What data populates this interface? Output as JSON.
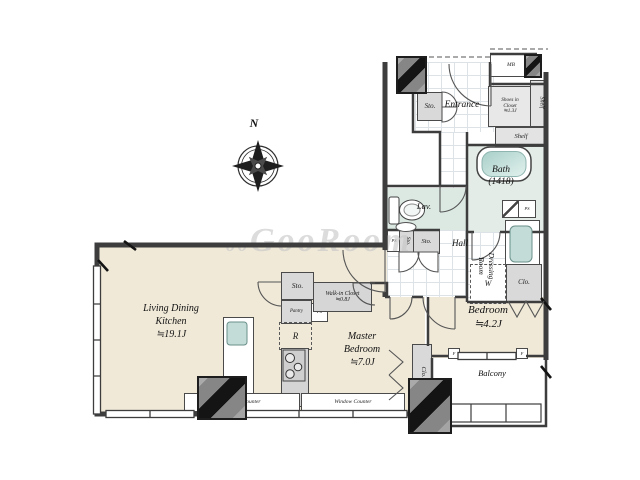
{
  "colors": {
    "floor_beige": "#f0e9d8",
    "wet_area_teal": "#dce9e3",
    "fixture_teal": "#b9d6d1",
    "wall_dark": "#3d3d3d",
    "closet_gray": "#d9d9d9",
    "watermark_gray": "#c7c7c7"
  },
  "watermark": {
    "prefix": "oo",
    "text": "GooRoom"
  },
  "compass": {
    "north": "N"
  },
  "labels": {
    "ldk": "Living Dining\nKitchen\n≒19.1J",
    "master_bedroom": "Master\nBedroom\n≒7.0J",
    "bedroom": "Bedroom\n≒4.2J",
    "balcony": "Balcony",
    "bath": "Bath\n(1418)",
    "lav": "Lav.",
    "hall": "Hall",
    "entrance": "Entrance",
    "dressing_room": "Dressing\nRoom",
    "mb": "MB",
    "shoes_in_closet": "Shoes in\nCloset\n≒1.3J",
    "shelf_side": "Shelf",
    "shelf_bottom": "Shelf",
    "sto_entrance": "Sto.",
    "sto_hall_small": "Sto.",
    "sto_hall": "Sto.",
    "ps_hall": "PS",
    "ps_wall": "PS",
    "washer": "W",
    "clo_dressing": "Clo.",
    "clo_bedroom": "Clo.",
    "sto_kitchen": "Sto.",
    "pantry": "Pantry",
    "ps_kitchen": "PS",
    "fridge": "R",
    "walk_in_closet": "Walk-in Closet\n≒0.8J",
    "window_counter_left": "Window Counter",
    "window_counter_right": "Window Counter",
    "fix_window_left": "F",
    "fix_window_right": "F"
  }
}
